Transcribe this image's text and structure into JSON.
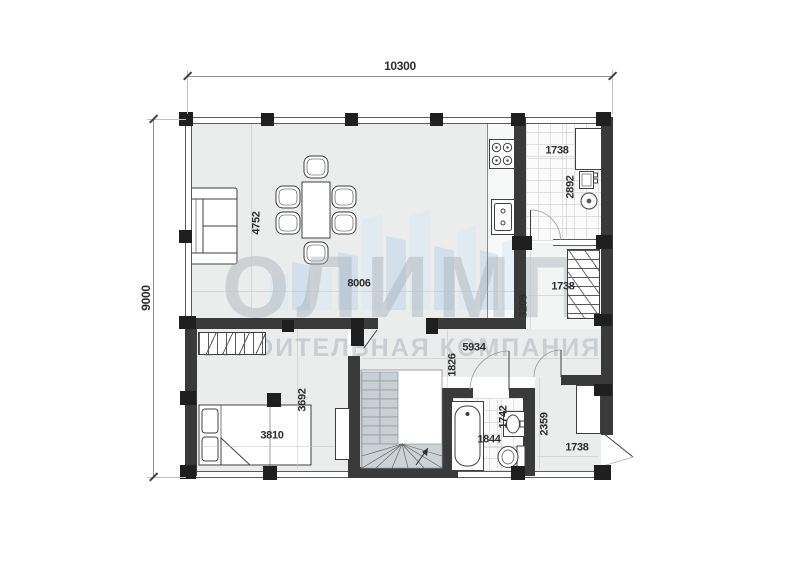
{
  "watermark": {
    "brand": "ОЛИМП",
    "tagline": "СТРОИТЕЛЬНАЯ КОМПАНИЯ"
  },
  "dimensions": {
    "total_width": "10300",
    "total_depth": "9000",
    "living": {
      "depth": "4752",
      "width": "8006"
    },
    "pantry": {
      "width": "1738",
      "depth": "2892"
    },
    "ladder": {
      "width": "1738",
      "depth": "3209"
    },
    "hall": {
      "width": "5934",
      "depth": "1826"
    },
    "bedroom": {
      "width": "3810",
      "depth": "3692"
    },
    "bathroom": {
      "depth": "1742",
      "width": "1844"
    },
    "entry": {
      "depth": "2359",
      "width": "1738"
    }
  },
  "colors": {
    "wall": "#3a3a3a",
    "floor": "#ebecec",
    "logo_blue": "#bdd6ea",
    "logo_gray": "#aab2b9",
    "stair_tread": "#c9d0d5"
  }
}
